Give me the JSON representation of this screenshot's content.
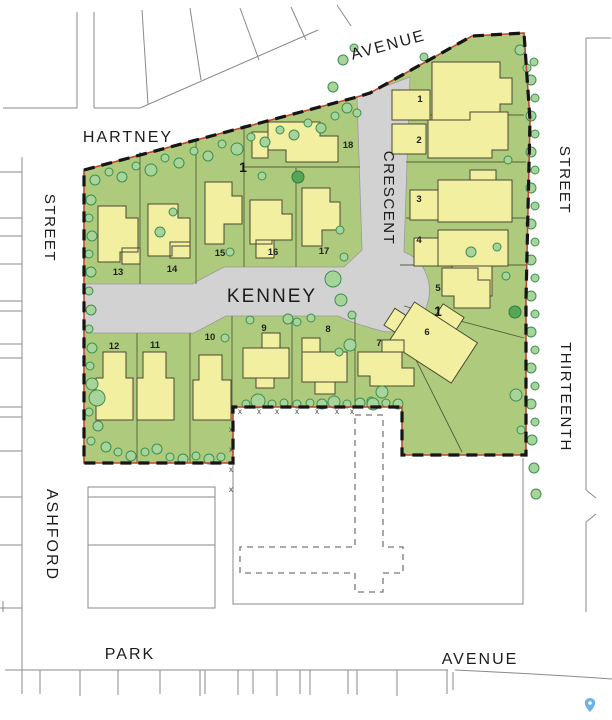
{
  "title": "Kenney Crescent subdivision site plan",
  "streets": {
    "hartney": "HARTNEY",
    "avenue_top": "AVENUE",
    "street_west": "STREET",
    "street_east": "STREET",
    "crescent": "CRESCENT",
    "kenney": "KENNEY",
    "thirteenth": "THIRTEENTH",
    "ashford": "ASHFORD",
    "park": "PARK",
    "avenue_south": "AVENUE"
  },
  "lots": [
    {
      "number": "1"
    },
    {
      "number": "2"
    },
    {
      "number": "3"
    },
    {
      "number": "4"
    },
    {
      "number": "5"
    },
    {
      "number": "6"
    },
    {
      "number": "7"
    },
    {
      "number": "8"
    },
    {
      "number": "9"
    },
    {
      "number": "10"
    },
    {
      "number": "11"
    },
    {
      "number": "12"
    },
    {
      "number": "13"
    },
    {
      "number": "14"
    },
    {
      "number": "15"
    },
    {
      "number": "16"
    },
    {
      "number": "17"
    },
    {
      "number": "18"
    }
  ],
  "annotations": {
    "marker_a": "1",
    "marker_b": "1",
    "fence_mark": "x"
  },
  "icons": {
    "map_pin": "map-pin"
  },
  "colors": {
    "parcel_green": "#aecb7d",
    "house_yellow": "#f2efa0",
    "road_gray": "#d2d2d2",
    "boundary_red": "#c0472b",
    "boundary_black": "#151515",
    "tree_fill": "#a7d49b",
    "tree_stroke": "#3e8e4f",
    "context_line": "#8a8a8a",
    "pin_blue": "#6db3e8"
  }
}
